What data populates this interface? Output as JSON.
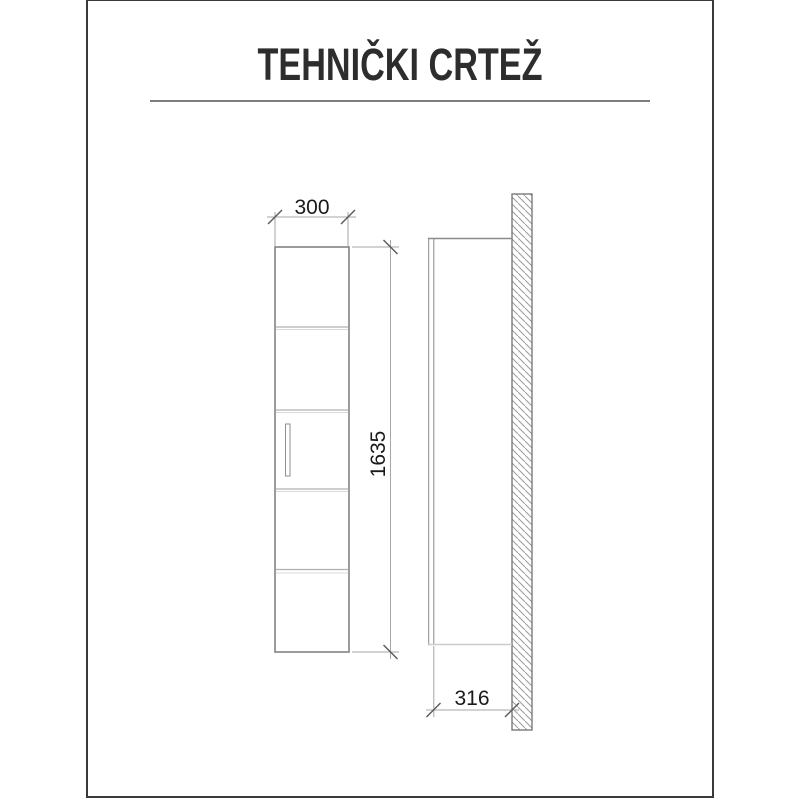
{
  "header": {
    "title": "TEHNIČKI CRTEŽ"
  },
  "dimensions": {
    "width": "300",
    "height": "1635",
    "depth": "316"
  },
  "front_view": {
    "shelf_count": 4,
    "sections": 5
  },
  "colors": {
    "frame_border": "#3a3a3a",
    "title_text": "#2d2d2d",
    "divider": "#7d7d7d",
    "cabinet_outline": "#7a7a7a",
    "shelf_line": "#b0b0b0",
    "dimension_line": "#a6a6a6",
    "tick_mark": "#5a5a5a",
    "dimension_text": "#1a1a1a",
    "hatch_line": "#9a9a9a",
    "background": "#ffffff"
  }
}
